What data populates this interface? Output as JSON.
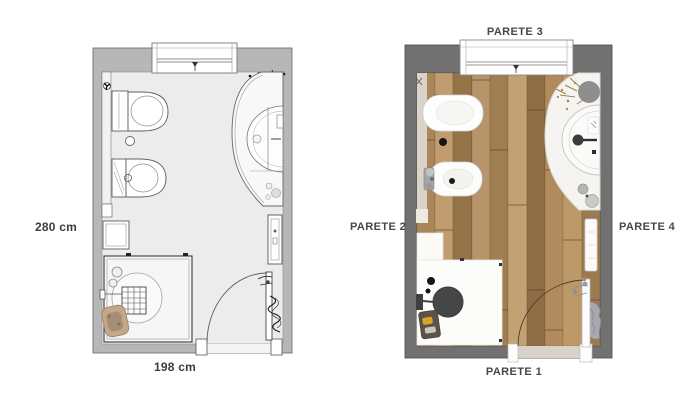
{
  "figure": {
    "title": "Bathroom floor plan, technical drawing and rendered top view"
  },
  "left_plan": {
    "style": "technical line drawing",
    "dimensions": {
      "height": "280 cm",
      "width": "198 cm"
    },
    "fixtures": [
      "window",
      "toilet",
      "bidet",
      "curved washbasin counter",
      "shower enclosure",
      "shelf",
      "towel radiator",
      "towel",
      "door",
      "plant",
      "bath mat"
    ]
  },
  "right_plan": {
    "style": "rendered top view",
    "floor": "wood planks",
    "wall_labels": [
      {
        "id": "parete-1",
        "text": "PARETE 1",
        "side": "bottom"
      },
      {
        "id": "parete-2",
        "text": "PARETE 2",
        "side": "left"
      },
      {
        "id": "parete-3",
        "text": "PARETE 3",
        "side": "top"
      },
      {
        "id": "parete-4",
        "text": "PARETE 4",
        "side": "right"
      }
    ],
    "fixtures": [
      "window",
      "toilet",
      "bidet",
      "curved washbasin counter",
      "shower",
      "shower column",
      "towel radiator",
      "towel",
      "door",
      "plant",
      "bath mat",
      "accessories"
    ]
  },
  "colors": {
    "background": "#ffffff",
    "left_plan_wall": "#b7b7b7",
    "left_plan_floor": "#ececec",
    "right_plan_wall": "#717171",
    "wood_light": "#c2a173",
    "wood_dark": "#8e6d44",
    "beige_strip": "#d9d3c9",
    "label_text": "#3c3c3c"
  }
}
